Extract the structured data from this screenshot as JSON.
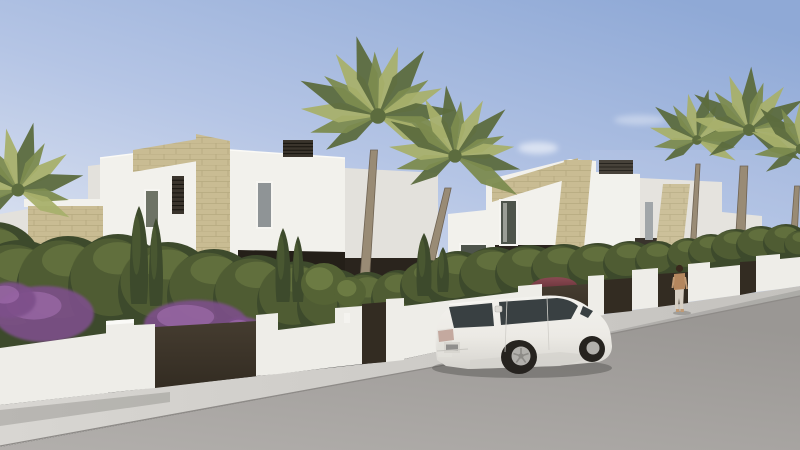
{
  "meta": {
    "kind": "architectural-render",
    "subject": "modern white villas with stone accents, fan palms, hedges with purple bougainvillea, white SUV parked on street, pedestrian at gate",
    "width": 800,
    "height": 450
  },
  "palette": {
    "sky_top": "#8fa9d6",
    "sky_mid": "#b5c5e5",
    "sky_low": "#e4e9f3",
    "cloud": "#ffffff",
    "wall_lit": "#f2f1ec",
    "wall_mid": "#e3e1dc",
    "wall_shade": "#cfcdc7",
    "roof_line": "#fbfaf6",
    "parapet_shadow": "#c6c4bf",
    "stone": "#c9bc93",
    "stone_line": "#a3966e",
    "dark_opening": "#241f18",
    "dark_opening2": "#2a241d",
    "louver_dark": "#3a342c",
    "louver_slat": "#17140f",
    "glass_dark": "#4e544b",
    "glass_gray": "#8f9496",
    "glass_olive": "#6e7366",
    "slit_gray": "#9aa0a3",
    "hedge_dark": "#3d4a2c",
    "hedge_mid": "#556335",
    "hedge_light": "#8a9a55",
    "flower_purple": "#7d4f8a",
    "flower_light": "#a873b5",
    "gate_brown": "#453c30",
    "gate_brown_dark": "#332c22",
    "pillar_white": "#eeede8",
    "pillar_cap": "#fafaf7",
    "sidewalk_near": "#d8d6d2",
    "sidewalk_far": "#c4c2be",
    "road_near": "#b2afac",
    "road_far": "#9a9794",
    "curb": "#8e8b88",
    "shadow": "#2a2a28",
    "trunk": "#998b75",
    "trunk_shade": "#6f6353",
    "frond_dark": "#5c6c3e",
    "frond_mid": "#7c8b4f",
    "frond_light": "#a8b06b",
    "car_body_hi": "#f3f2ee",
    "car_body": "#eceae5",
    "car_body_lo": "#d6d4cf",
    "car_glass": "#394042",
    "wheel_dark": "#26231f",
    "alloy": "#b2b0ac",
    "alloy_hub": "#8d8b87",
    "taillight": "#c4a99f",
    "plate": "#d8d6d0",
    "plate_text": "#555555",
    "maroon_car": "#5c2730",
    "maroon_hi": "#8a4a52",
    "skin": "#c09a74",
    "person_top": "#b4875e",
    "person_pants": "#d6cec2",
    "hair": "#38281c"
  },
  "scene": {
    "clouds": [
      [
        538,
        148,
        20,
        6,
        0.55
      ],
      [
        640,
        120,
        26,
        5,
        0.35
      ],
      [
        420,
        125,
        18,
        4,
        0.3
      ],
      [
        755,
        270,
        42,
        9,
        0.6
      ],
      [
        705,
        288,
        38,
        7,
        0.5
      ],
      [
        790,
        283,
        30,
        6,
        0.5
      ]
    ],
    "palms": [
      {
        "cx": 18,
        "cy": 190,
        "r": 72,
        "n": 12
      },
      {
        "cx": 378,
        "cy": 116,
        "r": 86,
        "n": 15,
        "trunk": [
          363,
          303,
          374,
          150,
          10
        ]
      },
      {
        "cx": 455,
        "cy": 156,
        "r": 74,
        "n": 14,
        "trunk": [
          421,
          302,
          448,
          188,
          9
        ]
      },
      {
        "cx": 697,
        "cy": 140,
        "r": 54,
        "n": 12,
        "trunk": [
          691,
          278,
          698,
          164,
          6
        ]
      },
      {
        "cx": 749,
        "cy": 130,
        "r": 66,
        "n": 13,
        "trunk": [
          736,
          318,
          744,
          166,
          11
        ]
      },
      {
        "cx": 801,
        "cy": 149,
        "r": 58,
        "n": 11,
        "trunk": [
          793,
          252,
          797,
          186,
          7
        ]
      }
    ],
    "hedges": [
      [
        -5,
        268,
        48,
        46
      ],
      [
        20,
        296,
        55,
        56
      ],
      [
        68,
        290,
        52,
        54
      ],
      [
        118,
        288,
        50,
        54
      ],
      [
        168,
        292,
        50,
        50
      ],
      [
        214,
        296,
        47,
        47
      ],
      [
        257,
        299,
        44,
        44
      ],
      [
        299,
        303,
        42,
        42
      ],
      [
        334,
        307,
        37,
        38
      ],
      [
        368,
        306,
        31,
        34
      ],
      [
        398,
        300,
        27,
        30
      ],
      [
        428,
        288,
        28,
        28
      ],
      [
        458,
        282,
        33,
        31
      ],
      [
        494,
        278,
        35,
        31
      ],
      [
        529,
        274,
        34,
        29
      ],
      [
        564,
        271,
        33,
        27
      ],
      [
        598,
        268,
        31,
        25
      ],
      [
        630,
        264,
        27,
        23
      ],
      [
        658,
        262,
        23,
        21
      ],
      [
        688,
        257,
        21,
        19
      ],
      [
        711,
        253,
        23,
        19
      ],
      [
        736,
        249,
        25,
        20
      ],
      [
        761,
        246,
        25,
        20
      ],
      [
        786,
        243,
        23,
        19
      ],
      [
        801,
        246,
        17,
        16
      ]
    ],
    "cypresses": [
      [
        139,
        206,
        304,
        17
      ],
      [
        156,
        218,
        306,
        13
      ],
      [
        283,
        228,
        302,
        14
      ],
      [
        298,
        236,
        302,
        11
      ],
      [
        424,
        233,
        296,
        14
      ],
      [
        443,
        247,
        292,
        11
      ]
    ],
    "shrubs": [
      [
        324,
        284,
        23,
        21
      ],
      [
        350,
        292,
        16,
        15
      ]
    ],
    "flowers": [
      [
        44,
        314,
        50,
        28
      ],
      [
        10,
        300,
        26,
        18
      ],
      [
        196,
        324,
        52,
        24
      ],
      [
        243,
        331,
        22,
        14
      ],
      [
        432,
        321,
        13,
        8
      ],
      [
        547,
        297,
        11,
        6
      ],
      [
        792,
        268,
        11,
        7
      ]
    ],
    "louvers": [
      [
        283,
        140,
        30,
        17,
        5
      ],
      [
        172,
        176,
        12,
        38,
        9
      ],
      [
        599,
        160,
        34,
        14,
        4
      ]
    ]
  }
}
